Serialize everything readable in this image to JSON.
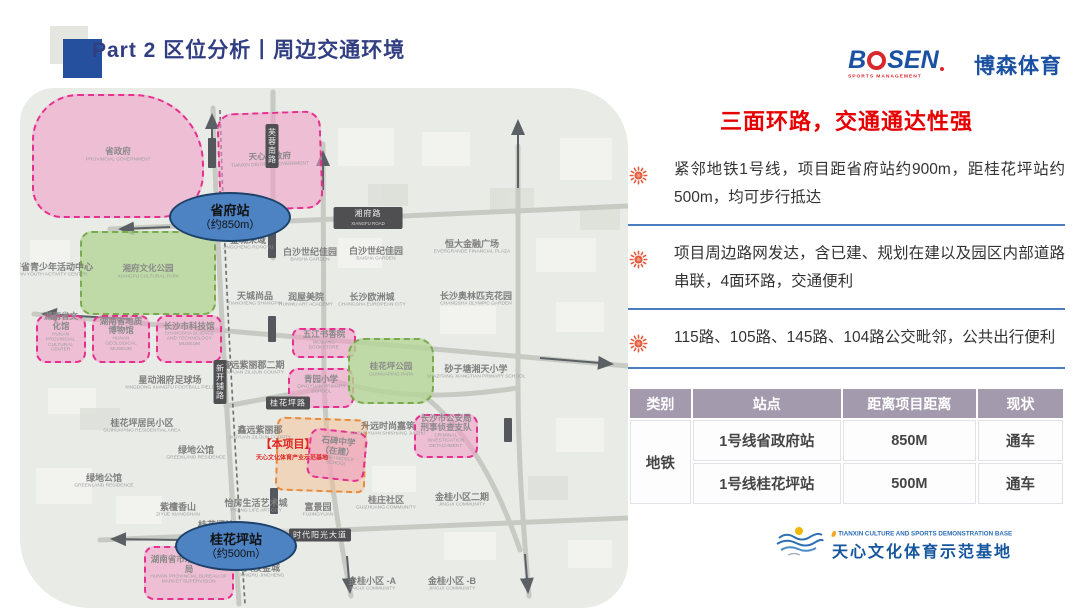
{
  "header": {
    "title": "Part 2 区位分析丨周边交通环境"
  },
  "brand": {
    "word_b": "B",
    "word_rest": "SEN",
    "tagline": "SPORTS MANAGEMENT",
    "cn": "博森体育"
  },
  "panel": {
    "headline": "三面环路，交通通达性强",
    "bullets": [
      {
        "icon": "sun-icon",
        "text": "紧邻地铁1号线，项目距省府站约900m，距桂花坪站约500m，均可步行抵达"
      },
      {
        "icon": "sun-icon",
        "text": "项目周边路网发达，含已建、规划在建以及园区内部道路串联，4面环路，交通便利"
      },
      {
        "icon": "sun-icon",
        "text": "115路、105路、145路、104路公交毗邻，公共出行便利"
      }
    ]
  },
  "table": {
    "headers": [
      "类别",
      "站点",
      "距离项目距离",
      "现状"
    ],
    "category": "地铁",
    "rows": [
      {
        "station": "1号线省政府站",
        "distance": "850M",
        "status": "通车"
      },
      {
        "station": "1号线桂花坪站",
        "distance": "500M",
        "status": "通车"
      }
    ]
  },
  "footer": {
    "en": "TIANXIN CULTURE AND SPORTS DEMONSTRATION BASE",
    "cn": "天心文化体育示范基地"
  },
  "map": {
    "stations": [
      {
        "name": "省府站",
        "dist": "（约850m）",
        "x": 210,
        "y": 129
      },
      {
        "name": "桂花坪站",
        "dist": "（约500m）",
        "x": 216,
        "y": 458
      }
    ],
    "zones": [
      {
        "id": "provincial-government",
        "type": "pink",
        "x": 12,
        "y": 6,
        "w": 172,
        "h": 124,
        "br": "46px 70px 44px 30px",
        "zh": "省政府",
        "en": "PROVINCIAL GOVERNMENT"
      },
      {
        "id": "tianxin-district-government",
        "type": "pink",
        "x": 198,
        "y": 24,
        "w": 104,
        "h": 98,
        "r": 16,
        "rot": -2,
        "zh": "天心区政府",
        "en": "TIANXIN DISTRICT GOVERNMENT"
      },
      {
        "id": "xiangfu-cultural-park",
        "type": "green",
        "x": 60,
        "y": 143,
        "w": 136,
        "h": 84,
        "r": 12,
        "zh": "湘府文化公园",
        "en": "XIANGFU CULTURAL PARK"
      },
      {
        "id": "hunan-cultural-center",
        "type": "pink",
        "x": 16,
        "y": 227,
        "w": 50,
        "h": 48,
        "r": 10,
        "zh": "湖南省文化馆",
        "en": "HUNAN PROVINCIAL CULTURAL CENTER"
      },
      {
        "id": "geological-museum",
        "type": "pink",
        "x": 72,
        "y": 227,
        "w": 58,
        "h": 48,
        "r": 10,
        "zh": "湖南省地质博物馆",
        "en": "HUNAN GEOLOGICAL MUSEUM"
      },
      {
        "id": "science-museum",
        "type": "pink",
        "x": 136,
        "y": 227,
        "w": 66,
        "h": 48,
        "r": 10,
        "zh": "长沙市科技馆",
        "en": "CHANGSHA SCIENCE AND TECHNOLOGY MUSEUM"
      },
      {
        "id": "wujiang-bookstore",
        "type": "pink",
        "x": 272,
        "y": 240,
        "w": 64,
        "h": 30,
        "r": 8,
        "zh": "五江书香院",
        "en": "WUJIANG BOOKSTORE"
      },
      {
        "id": "qingyuan-primary-school",
        "type": "pink",
        "x": 268,
        "y": 280,
        "w": 66,
        "h": 40,
        "r": 10,
        "zh": "青园小学",
        "en": "QINGYUAN PRIMARY SCHOOL"
      },
      {
        "id": "guihuaping-park",
        "type": "green",
        "x": 328,
        "y": 250,
        "w": 86,
        "h": 66,
        "r": 16,
        "zh": "桂花坪公园",
        "en": "GUIHUAPING PARK"
      },
      {
        "id": "project-site",
        "type": "orange",
        "x": 256,
        "y": 330,
        "w": 90,
        "h": 74,
        "r": 8,
        "rot": 2
      },
      {
        "id": "shibei-middle-school",
        "type": "pink",
        "x": 288,
        "y": 342,
        "w": 58,
        "h": 50,
        "r": 10,
        "rot": 6,
        "zh": "石碑中学（在建）",
        "en": "SHIBEI MIDDLE SCHOOL"
      },
      {
        "id": "criminal-investigation-detachment",
        "type": "pink",
        "x": 394,
        "y": 326,
        "w": 64,
        "h": 44,
        "r": 10,
        "zh": "长沙市公安局刑事侦查支队",
        "en": "CRIMINAL INVESTIGATION DETACHMENT"
      },
      {
        "id": "market-supervision-bureau",
        "type": "pink",
        "x": 124,
        "y": 458,
        "w": 90,
        "h": 54,
        "r": 10,
        "zh": "湖南省市场监督管理局",
        "en": "HUNAN PROVINCIAL BUREAU OF MARKET SUPERVISION"
      }
    ],
    "labels": [
      {
        "zh": "湖南省青少年活动中心",
        "en": "HUNAN YOUTH ACTIVITY CENTER",
        "x": 28,
        "y": 183
      },
      {
        "zh": "星动湘府足球场",
        "en": "XINGDONG XIANGFU FOOTBALL FIELD",
        "x": 150,
        "y": 296
      },
      {
        "zh": "桂花坪居民小区",
        "en": "GUIHUAPING RESIDENTIAL AREA",
        "x": 122,
        "y": 339
      },
      {
        "zh": "绿地公馆",
        "en": "GREENLAND RESIDENCE",
        "x": 176,
        "y": 366
      },
      {
        "zh": "绿地公馆",
        "en": "GREENLAND RESIDENCE",
        "x": 84,
        "y": 394
      },
      {
        "zh": "紫檀香山",
        "en": "ZIYUE XIANGSHAN",
        "x": 158,
        "y": 423
      },
      {
        "zh": "桂花坪站",
        "en": "",
        "x": 196,
        "y": 437
      },
      {
        "zh": "兴汝金城",
        "en": "XINGRU JINCHENG",
        "x": 242,
        "y": 484
      },
      {
        "zh": "金桂小区 -A",
        "en": "JINGUI COMMUNITY",
        "x": 352,
        "y": 497
      },
      {
        "zh": "金桂小区 -B",
        "en": "JINGUI COMMUNITY",
        "x": 432,
        "y": 497
      },
      {
        "zh": "桂庄社区",
        "en": "GUIZHUANG COMMUNITY",
        "x": 366,
        "y": 416
      },
      {
        "zh": "金桂小区二期",
        "en": "JINGUI COMMUNITY",
        "x": 442,
        "y": 413
      },
      {
        "zh": "富景园",
        "en": "FUJINGYUAN",
        "x": 298,
        "y": 423
      },
      {
        "zh": "怡房生活艺术城",
        "en": "YIFANG LIFE ART CITY",
        "x": 236,
        "y": 419
      },
      {
        "zh": "鑫远紫丽郡二期",
        "en": "XINYUAN ZILIJUN COUNTY",
        "x": 233,
        "y": 281
      },
      {
        "zh": "鑫远紫丽郡",
        "en": "XINYUAN ZILIJUN COUNTY",
        "x": 240,
        "y": 346
      },
      {
        "zh": "天城尚品",
        "en": "TIANCHENG SHANGPIN",
        "x": 235,
        "y": 212
      },
      {
        "zh": "润屋美院",
        "en": "RUNWU ART ACADEMY",
        "x": 286,
        "y": 213
      },
      {
        "zh": "白沙世纪佳园",
        "en": "BAISHA GARDEN",
        "x": 290,
        "y": 168
      },
      {
        "zh": "白沙世纪佳园",
        "en": "BAISHA GARDEN",
        "x": 356,
        "y": 167
      },
      {
        "zh": "金城荣域",
        "en": "JINGCHENG RONGYU",
        "x": 228,
        "y": 156
      },
      {
        "zh": "恒大金融广场",
        "en": "EVERGRANDE FINANCIAL PLAZA",
        "x": 452,
        "y": 160
      },
      {
        "zh": "长沙欧洲城",
        "en": "CHANGSHA EUROPEAN CITY",
        "x": 352,
        "y": 213
      },
      {
        "zh": "长沙奥林匹克花园",
        "en": "CHANGSHA OLYMPIC GARDEN",
        "x": 456,
        "y": 212
      },
      {
        "zh": "砂子塘湘天小学",
        "en": "SHAZITANG XIANGTIAN PRIMARY SCHOOL",
        "x": 456,
        "y": 285
      },
      {
        "zh": "升远时尚嘉筑",
        "en": "SHENGYUAN SHISHANG JIAZHU",
        "x": 368,
        "y": 342
      },
      {
        "zh": "【本项目】",
        "en": "",
        "x": 268,
        "y": 357,
        "red": true,
        "size": 11
      },
      {
        "zh": "天心文化体育产业示范基地",
        "en": "",
        "x": 272,
        "y": 371,
        "red": true,
        "size": 6
      }
    ],
    "badges": [
      {
        "text": "湘府路",
        "en": "XIANGFU ROAD",
        "x": 348,
        "y": 130
      },
      {
        "text": "芙蓉南路",
        "x": 252,
        "y": 58,
        "vertical": true
      },
      {
        "text": "新开铺路",
        "x": 200,
        "y": 294,
        "vertical": true
      },
      {
        "text": "桂花坪路",
        "x": 268,
        "y": 315
      },
      {
        "text": "时代阳光大道",
        "x": 300,
        "y": 447
      }
    ],
    "platforms": [
      {
        "x": 188,
        "y": 50,
        "w": 8,
        "h": 30
      },
      {
        "x": 248,
        "y": 140,
        "w": 8,
        "h": 30
      },
      {
        "x": 248,
        "y": 228,
        "w": 8,
        "h": 26
      },
      {
        "x": 196,
        "y": 276,
        "w": 8,
        "h": 28
      },
      {
        "x": 209,
        "y": 440,
        "w": 8,
        "h": 28
      },
      {
        "x": 250,
        "y": 400,
        "w": 8,
        "h": 26
      },
      {
        "x": 484,
        "y": 330,
        "w": 8,
        "h": 24
      }
    ]
  },
  "colors": {
    "headline_red": "#e60000",
    "title_navy": "#313e82",
    "divider_blue": "#4a7dbd",
    "table_header_mauve": "#a49aad",
    "brand_blue": "#1a51a2",
    "brand_red": "#d9272e",
    "station_blue": "#4d82c3",
    "zone_pink": "#e5308f",
    "zone_green": "#7aa94f",
    "zone_orange": "#e78a3c"
  }
}
